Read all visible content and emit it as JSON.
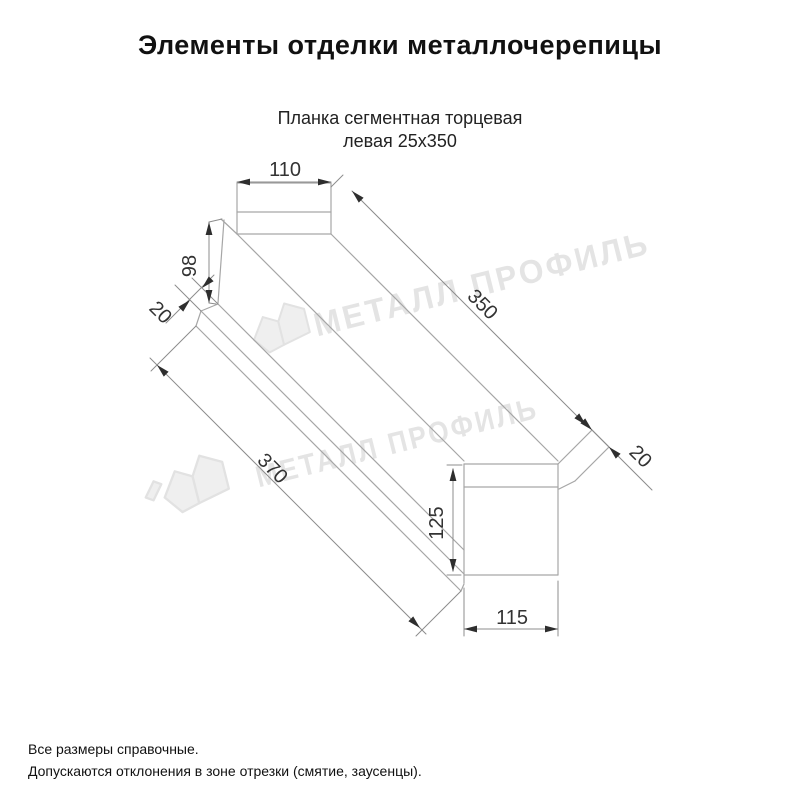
{
  "page": {
    "title": "Элементы отделки металлочерепицы"
  },
  "drawing": {
    "subtitle_line1": "Планка сегментная торцевая",
    "subtitle_line2": "левая 25х350",
    "dims": {
      "top_width": "110",
      "left_height": "98",
      "left_hem": "20",
      "length_top": "350",
      "length_bottom": "370",
      "end_hem": "20",
      "end_height": "125",
      "end_width": "115"
    },
    "watermark_text": "МЕТАЛЛ ПРОФИЛЬ"
  },
  "footer": {
    "note1": "Все размеры справочные.",
    "note2": "Допускаются отклонения в зоне отрезки (смятие, заусенцы)."
  },
  "colors": {
    "background": "#ffffff",
    "part_line": "#a6a6a6",
    "dim_line": "#8c8c8c",
    "dim_text": "#333333",
    "title_text": "#111111",
    "watermark": "#e4e4e4"
  }
}
